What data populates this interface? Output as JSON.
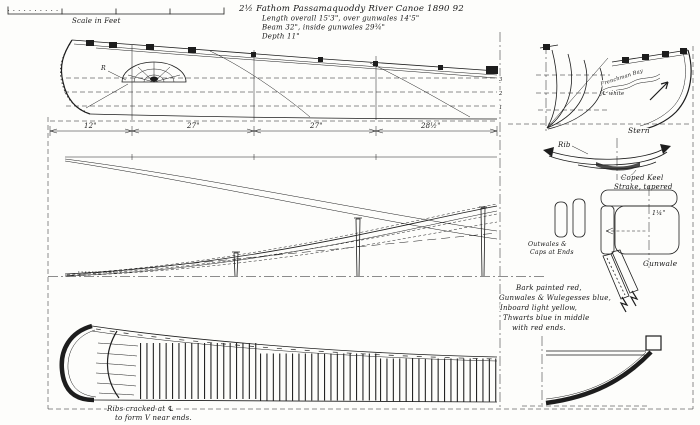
{
  "meta": {
    "ink_color": "#1d1d1d",
    "paper_color": "#fdfdfb"
  },
  "scale_bar": {
    "label": "Scale in Feet"
  },
  "title_block": {
    "line1": "2½ Fathom Passamaquoddy River Canoe 1890 92",
    "line2": "Length overall 15'3\", over gunwales 14'5\"",
    "line3": "Beam 32\", inside gunwales 29¾\"",
    "line4": "Depth 11\""
  },
  "profile_view": {
    "bow_design_ref": "R",
    "waterline_labels": [
      "3",
      "2",
      "1"
    ],
    "dimensions": [
      "12\"",
      "27\"",
      "27\"",
      "28½\""
    ]
  },
  "stern_detail": {
    "design_note": "Frenchman Bay",
    "centerline_note": "℄ white",
    "caption": "Stern"
  },
  "rib_detail": {
    "rib_label": "Rib",
    "keel_note_line1": "Coped Keel",
    "keel_note_line2": "Strake, tapered"
  },
  "outwales_detail": {
    "line1": "Outwales &",
    "line2": "Caps at Ends"
  },
  "gunwale_detail": {
    "dimension": "1¼\"",
    "caption": "Gunwale"
  },
  "color_note": {
    "lines": [
      "Bark painted red,",
      "Gunwales & Wulegesses blue,",
      "Inboard light yellow,",
      "Thwarts blue in middle",
      "with red ends."
    ]
  },
  "ribs_note": {
    "line1": "Ribs cracked at ℄",
    "line2": "to form V near ends."
  }
}
